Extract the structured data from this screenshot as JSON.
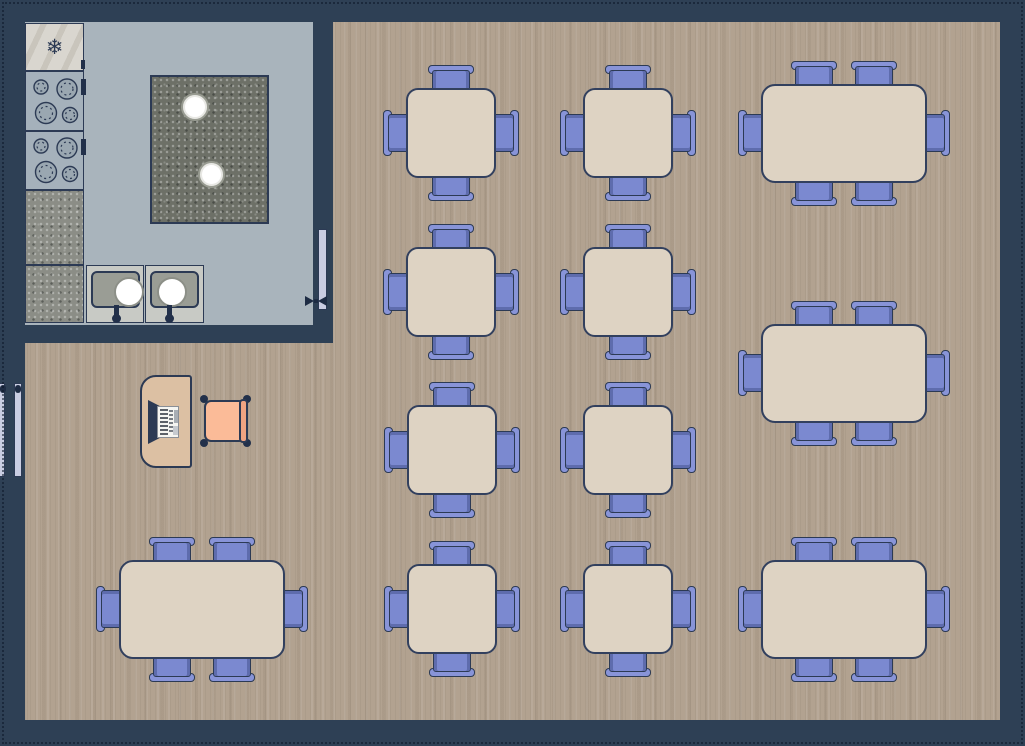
{
  "floorplan": {
    "type": "restaurant-floor-plan",
    "colors": {
      "wall": "#2e4055",
      "dining_floor": "#b2a290",
      "kitchen_floor": "#a9b4bc",
      "table_top": "#ded3c3",
      "chair": "#7b89d0",
      "chair_back": "#8894d8",
      "outline": "#2c3a54",
      "counter_granite": "#8b8d86",
      "island_granite": "#6d7067",
      "door": "#c9cde2",
      "desk": "#dcc0a3",
      "host_chair_cushion": "#fbbb98"
    },
    "kitchen": {
      "fixtures": [
        {
          "id": "refrigerator",
          "icon": "snowflake-icon",
          "glyph": "❄"
        },
        {
          "id": "stove-top-1",
          "burners": 4
        },
        {
          "id": "stove-top-2",
          "burners": 4
        },
        {
          "id": "counter-1",
          "surface": "granite"
        },
        {
          "id": "counter-2",
          "surface": "granite"
        },
        {
          "id": "island",
          "surface": "granite",
          "pots": 2
        },
        {
          "id": "sink-1",
          "bowls": 1
        },
        {
          "id": "sink-2",
          "bowls": 1
        }
      ]
    },
    "doors": [
      {
        "id": "kitchen-dining-door",
        "wall": "kitchen-right"
      },
      {
        "id": "entrance-door-outer",
        "wall": "dining-left"
      },
      {
        "id": "entrance-door-inner",
        "wall": "dining-left"
      }
    ],
    "host_station": {
      "desk": "rounded-left-desk",
      "equipment": "cash-register",
      "chair": "cushioned-chair"
    },
    "tables": [
      {
        "type": "square4",
        "seats": 4,
        "cx": 451,
        "cy": 133
      },
      {
        "type": "square4",
        "seats": 4,
        "cx": 628,
        "cy": 133
      },
      {
        "type": "square4",
        "seats": 4,
        "cx": 451,
        "cy": 292
      },
      {
        "type": "square4",
        "seats": 4,
        "cx": 628,
        "cy": 292
      },
      {
        "type": "square4",
        "seats": 4,
        "cx": 452,
        "cy": 450
      },
      {
        "type": "square4",
        "seats": 4,
        "cx": 628,
        "cy": 450
      },
      {
        "type": "square4",
        "seats": 4,
        "cx": 452,
        "cy": 609
      },
      {
        "type": "square4",
        "seats": 4,
        "cx": 628,
        "cy": 609
      },
      {
        "type": "rect6",
        "seats": 6,
        "cx": 844,
        "cy": 133
      },
      {
        "type": "rect6",
        "seats": 6,
        "cx": 844,
        "cy": 373
      },
      {
        "type": "rect6",
        "seats": 6,
        "cx": 844,
        "cy": 609
      },
      {
        "type": "rect6",
        "seats": 6,
        "cx": 202,
        "cy": 609
      }
    ],
    "summary": {
      "square_tables": 8,
      "rectangular_tables": 4,
      "total_seats": 56
    }
  }
}
